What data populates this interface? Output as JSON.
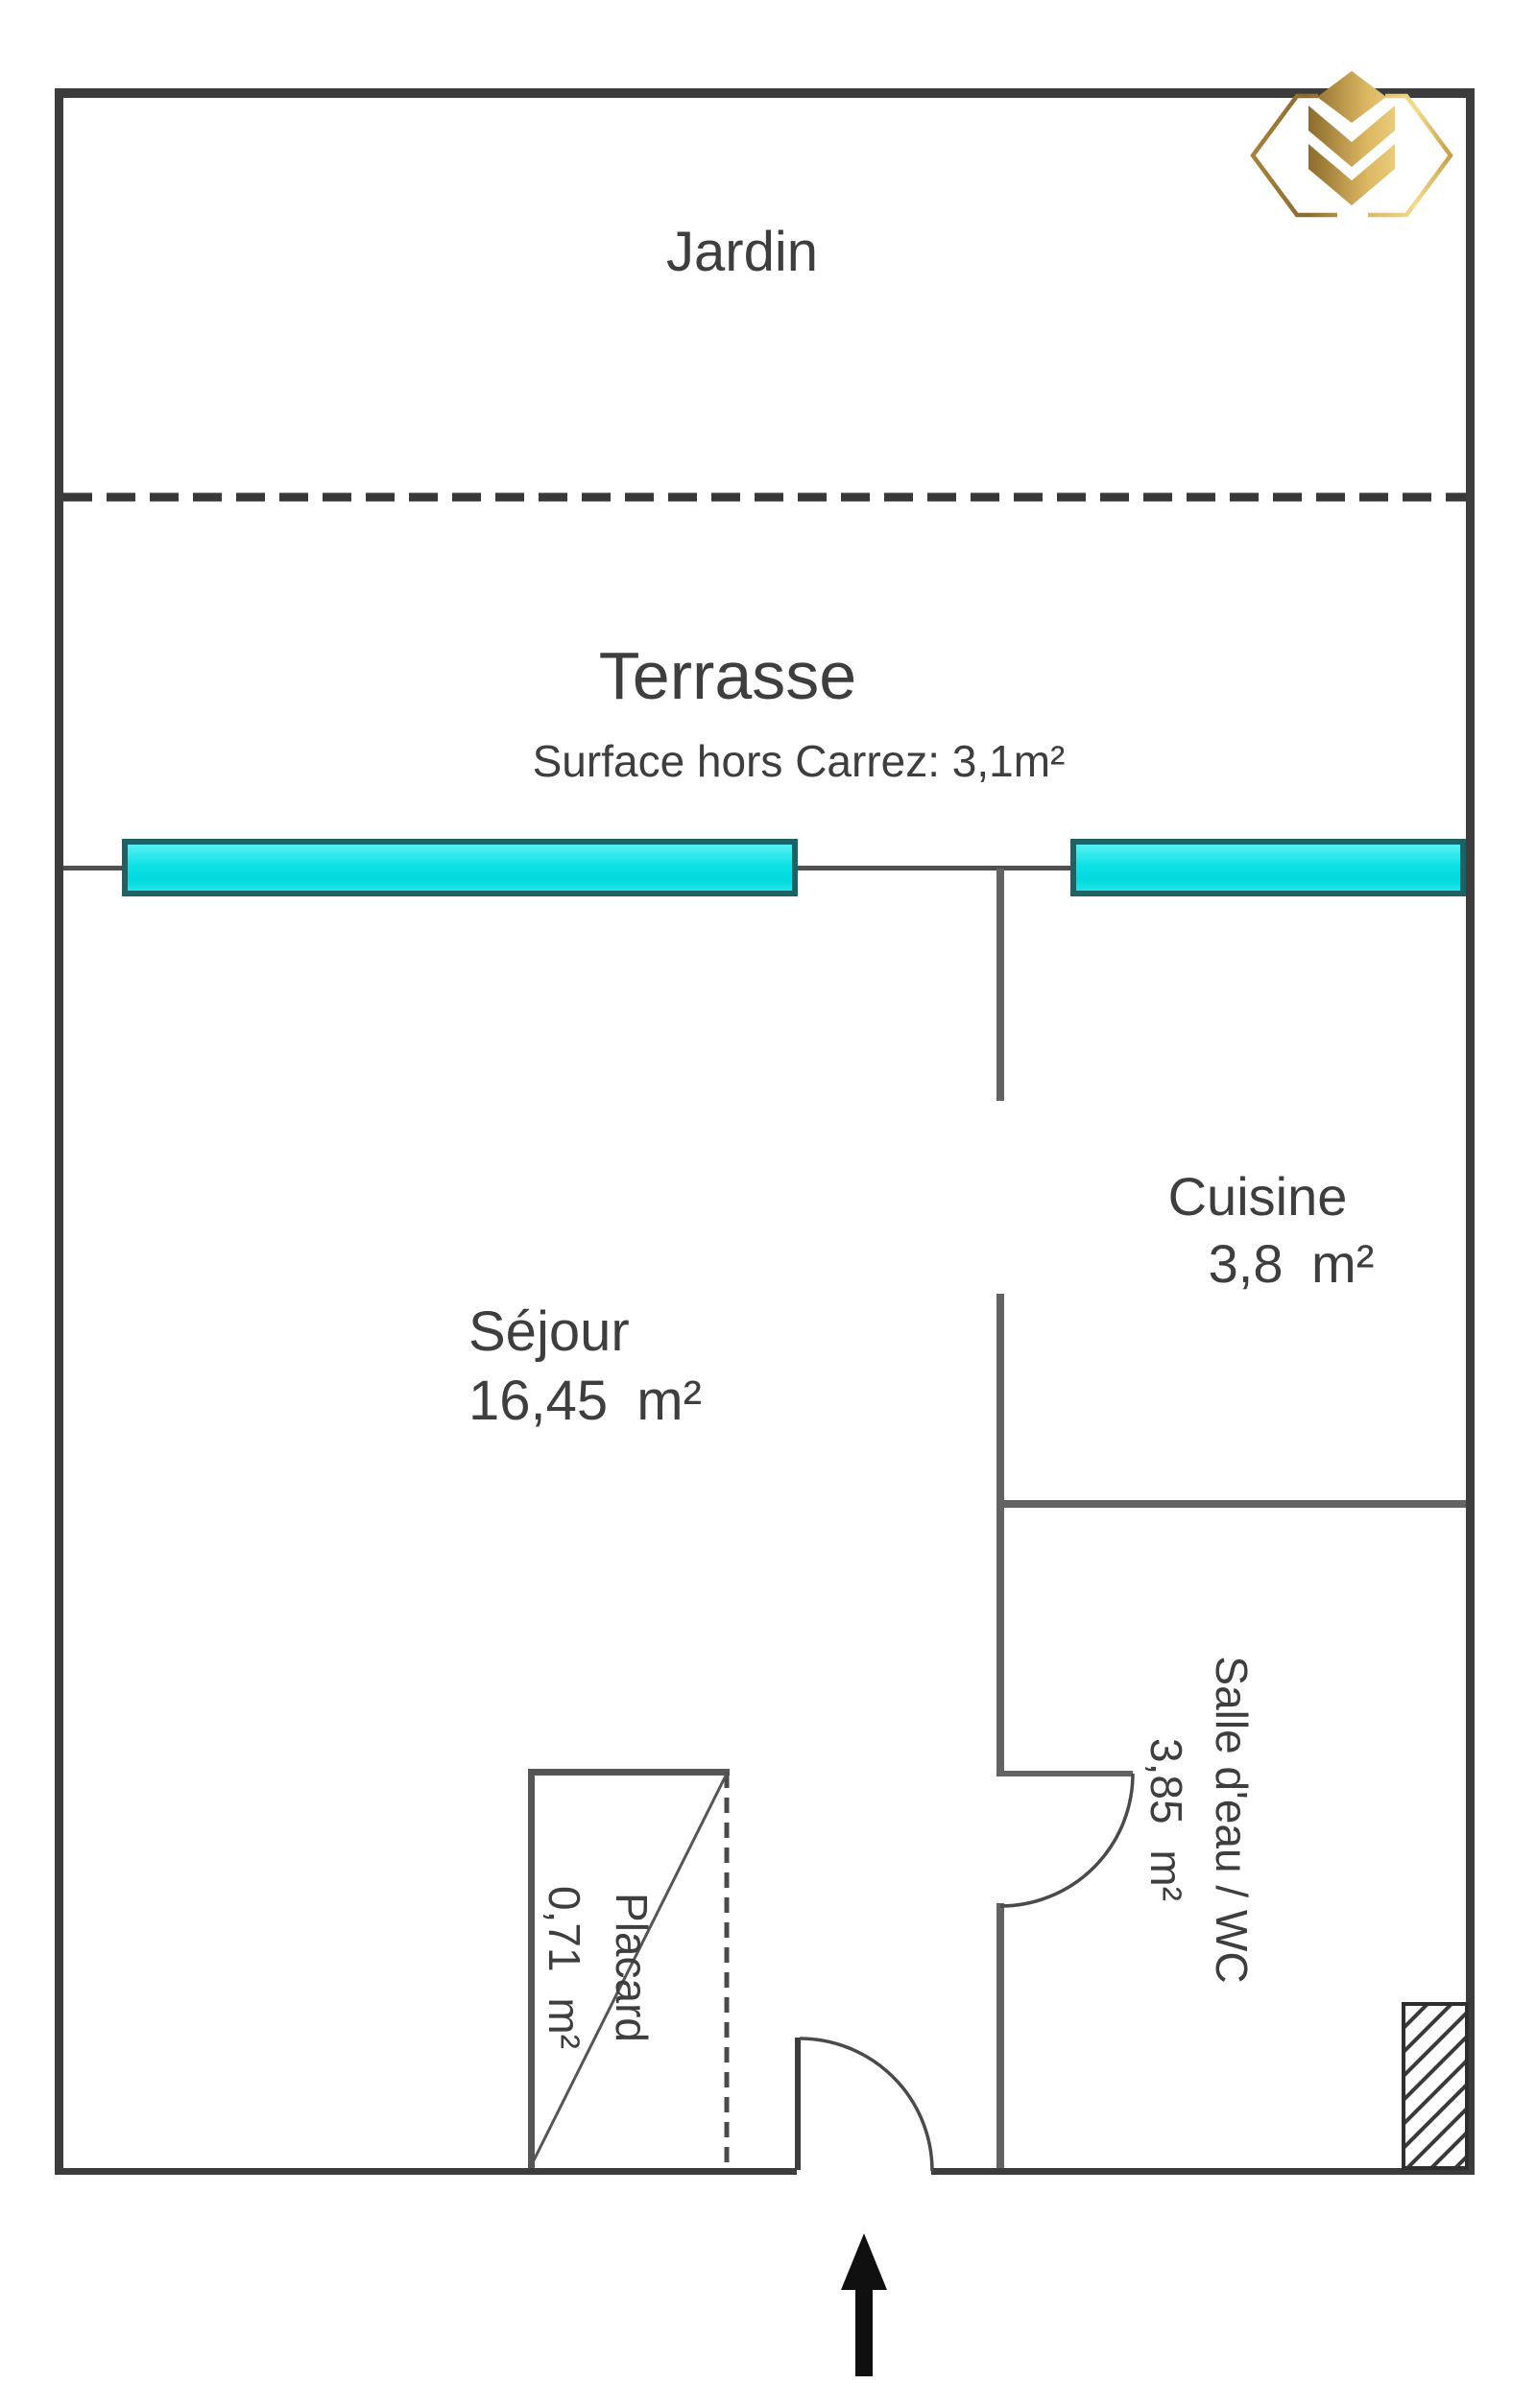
{
  "rooms": {
    "jardin": {
      "label": "Jardin"
    },
    "terrasse": {
      "label": "Terrasse",
      "note": "Surface hors Carrez: 3,1m²"
    },
    "sejour": {
      "label": "Séjour",
      "area": "16,45 m²"
    },
    "cuisine": {
      "label": "Cuisine",
      "area": "3,8 m²"
    },
    "salle_eau": {
      "label": "Salle d'eau / WC",
      "area": "3,85 m²"
    },
    "placard": {
      "label": "Placard",
      "area": "0,71 m²"
    }
  },
  "icons": {
    "logo": "gold-hexagon-chevrons",
    "entrance_arrow": "arrow-up"
  },
  "colors": {
    "wall_exterior": "#3c3c3c",
    "wall_interior": "#636363",
    "window_fill": "#0fe2e5",
    "window_border": "#1e6163",
    "logo_gold": "#caa24c",
    "text": "#3e3e3e"
  }
}
